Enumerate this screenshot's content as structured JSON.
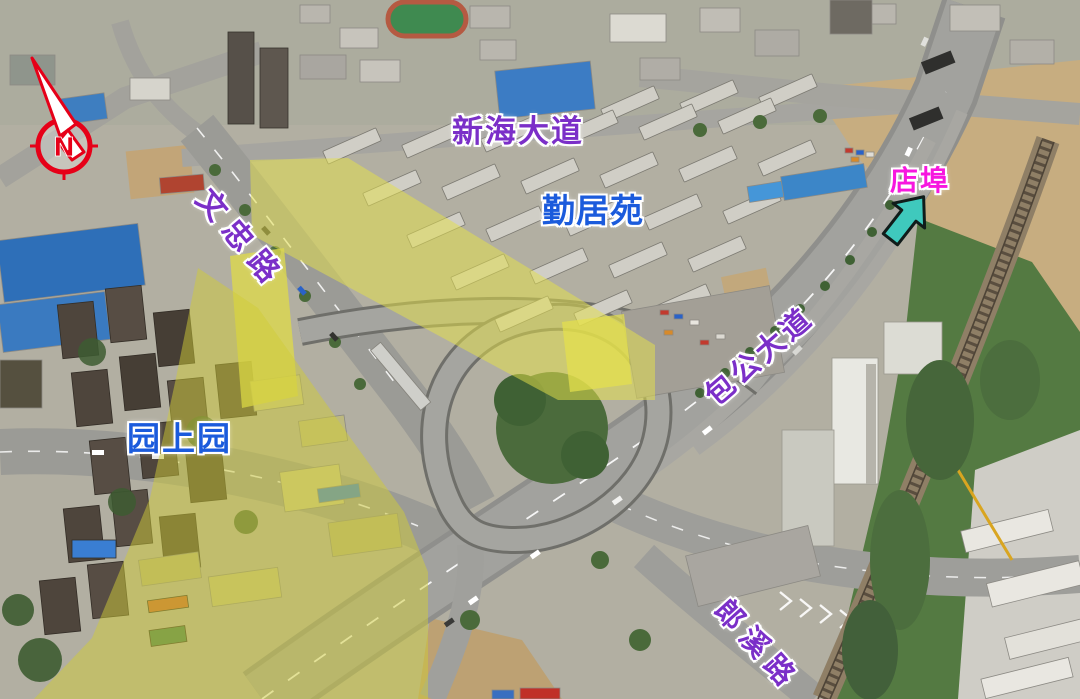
{
  "scene": {
    "type": "annotated aerial photograph",
    "area": "highway interchange and residential district"
  },
  "compass": {
    "letter": "N",
    "color": "#e60018"
  },
  "labels": {
    "road_top": {
      "text": "新海大道",
      "color": "#7b2fc8"
    },
    "residential_center": {
      "text": "勤居苑",
      "color": "#1b5bdc"
    },
    "direction_town": {
      "text": "店埠",
      "color": "#f717df"
    },
    "road_left": {
      "text": "文忠路",
      "color": "#7b2fc8"
    },
    "residential_left": {
      "text": "园上园",
      "color": "#1b5bdc"
    },
    "road_main": {
      "text": "包公大道",
      "color": "#7b2fc8"
    },
    "road_bottom": {
      "text": "郎溪路",
      "color": "#7b2fc8"
    }
  },
  "markers": {
    "direction_arrow_color": "#3fc9bd",
    "highlight_color": "#e5e14b"
  }
}
